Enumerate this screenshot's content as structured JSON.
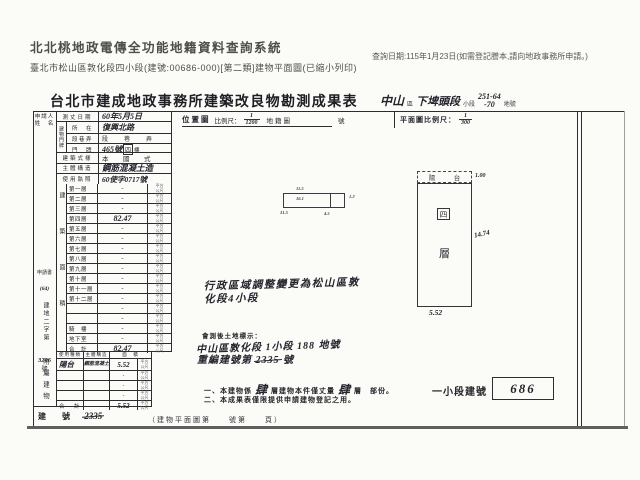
{
  "header": {
    "system_title": "北北桃地政電傳全功能地籍資料查詢系統",
    "query_date": "查詢日期:115年1月23日(如需登記謄本,請向地政事務所申請。)",
    "subtitle": "臺北市松山區敦化段四小段(建號:00686-000)[第二類]建物平面圖(已縮小列印)"
  },
  "document": {
    "title": "台北市建成地政事務所建築改良物勘測成果表",
    "title_right": {
      "district": "中山",
      "district_suffix": "區",
      "section": "下埤頭段",
      "subsection_label": "小段",
      "lot_top": "251-64",
      "lot_bottom": "-70",
      "lot_suffix": "地號"
    },
    "applicant_label_1": "申請人",
    "applicant_label_2": "姓　名",
    "case_no": {
      "line1": "申請書",
      "line2": "(64)",
      "vert": "建地二字第",
      "number": "3206",
      "suffix": "號"
    },
    "info_rows": {
      "survey_date_label": "測丈日期",
      "survey_date_value": "60年5月5日",
      "address_group_label": "建物門牌",
      "addr_location_label": "所　在",
      "addr_location_value": "復興北路",
      "addr_section_label": "段巷弄",
      "addr_section_value": "段　巷　弄",
      "addr_number_label": "門　牌",
      "addr_number_value": "465號",
      "addr_number_floor": "四",
      "addr_number_floor_suffix": "樓",
      "style_label": "建築式樣",
      "style_value": "本　國　式",
      "structure_label": "主體構造",
      "structure_value": "鋼筋混凝土造",
      "license_label": "使用執照",
      "license_value": "60使字0717號"
    },
    "floor_area_side_label": "建築面積",
    "unit_sqm": "平方公尺",
    "floors": [
      {
        "label": "第一層",
        "value": "-"
      },
      {
        "label": "第二層",
        "value": "-"
      },
      {
        "label": "第三層",
        "value": "-"
      },
      {
        "label": "第四層",
        "value": "82.47"
      },
      {
        "label": "第五層",
        "value": "-"
      },
      {
        "label": "第六層",
        "value": "-"
      },
      {
        "label": "第七層",
        "value": "-"
      },
      {
        "label": "第八層",
        "value": "-"
      },
      {
        "label": "第九層",
        "value": "-"
      },
      {
        "label": "第十層",
        "value": "-"
      },
      {
        "label": "第十一層",
        "value": "-"
      },
      {
        "label": "第十二層",
        "value": "-"
      },
      {
        "label": "",
        "value": "-"
      },
      {
        "label": "",
        "value": "-"
      },
      {
        "label": "騎　樓",
        "value": "-"
      },
      {
        "label": "地下室",
        "value": "-"
      },
      {
        "label": "合　計",
        "value": "82.47"
      }
    ],
    "attached_side_label": "附屬建物",
    "attached_headers": {
      "use": "使用種類",
      "structure": "主體構造",
      "area": "面　積"
    },
    "attached_rows": [
      {
        "use": "陽台",
        "structure": "鋼筋混凝土",
        "area": "5.52"
      },
      {
        "use": "",
        "structure": "",
        "area": "-"
      },
      {
        "use": "",
        "structure": "",
        "area": "-"
      },
      {
        "use": "",
        "structure": "",
        "area": "-"
      },
      {
        "use": "合　計",
        "structure": "",
        "area": "5.52"
      }
    ],
    "old_building_no_label": "建　號",
    "old_building_no_value": "2335",
    "location_map": {
      "label": "位置圖",
      "scale_label": "比例尺：",
      "scale_num": "1",
      "scale_den": "1200",
      "map_label": "地籍圖",
      "map_no_suffix": "號",
      "sketch_dims": {
        "top": "11.5",
        "inner": "16.1",
        "bottom_left": "31.5",
        "bottom_right": "4.5",
        "right": "1.2"
      }
    },
    "floor_plan": {
      "label": "平面圖比例尺：",
      "scale_num": "1",
      "scale_den": "300",
      "balcony": "陽　台",
      "balcony_dim": "1.00",
      "floor_boxed": "四",
      "floor_char": "層",
      "right_dim": "14.74",
      "bottom_dim": "5.52"
    },
    "admin_note_line1": "行政區域調整變更為松山區敦",
    "admin_note_line2": "化段4小段",
    "resurvey": {
      "title": "會測後土地標示：",
      "line1": "中山區敦化段 1小段 188 地號",
      "line2_prefix": "重編建號第",
      "line2_struck": "2335",
      "line2_suffix": "號"
    },
    "notes": {
      "n1_a": "一、本建物係",
      "n1_hw1": "肆",
      "n1_b": "層建物本件僅丈量",
      "n1_hw2": "肆",
      "n1_c": "層　部份。",
      "n2": "二、本成果表僅限提供申請建物登記之用。"
    },
    "new_no": {
      "label": "一小段建號",
      "value": "686"
    },
    "footer": "（建物平面圖第　　號第　　頁）"
  }
}
